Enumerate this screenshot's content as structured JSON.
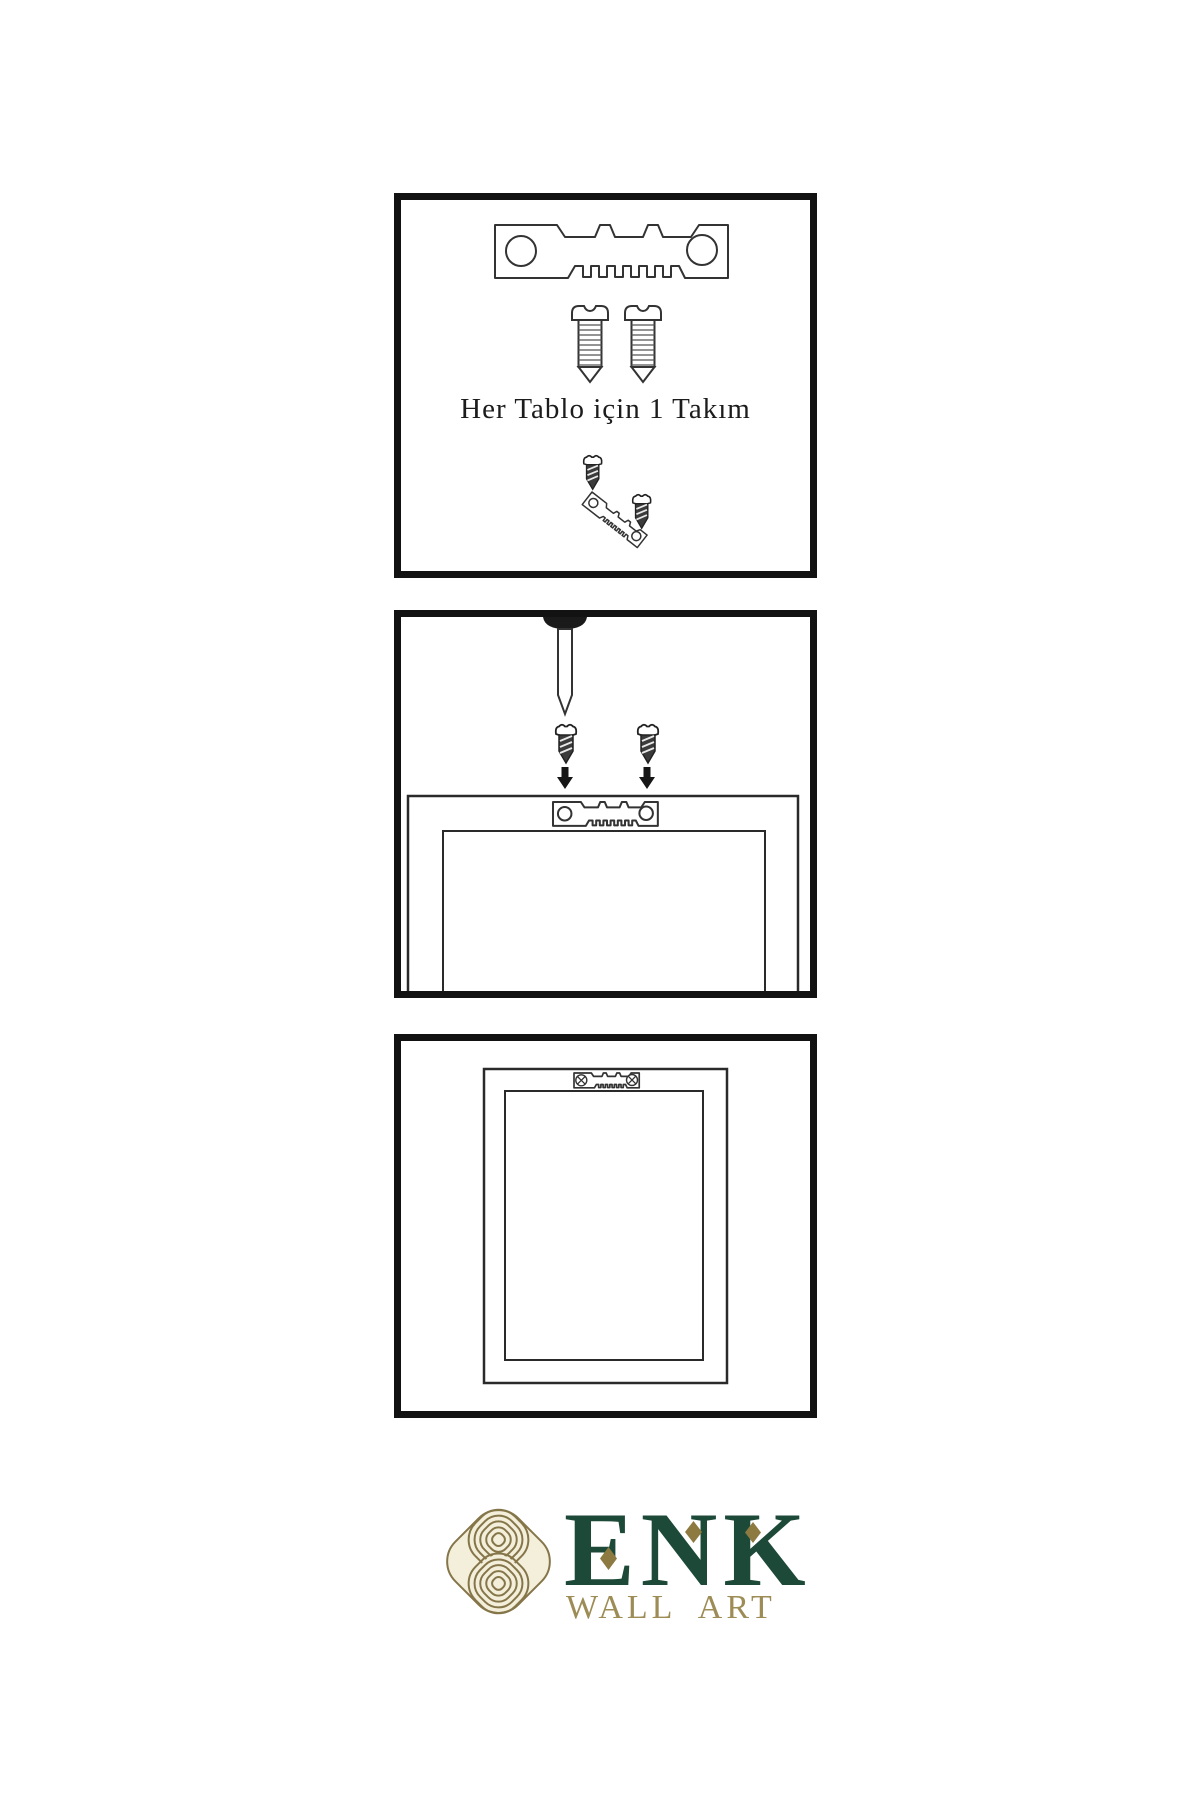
{
  "page": {
    "background": "#ffffff",
    "ink": "#333333",
    "panel_border": "#121212"
  },
  "step1": {
    "caption": "Her Tablo için 1 Takım"
  },
  "icons": {
    "panel1": [
      "sawtooth-hanger-icon",
      "screw-icon",
      "screw-icon",
      "screw-icon",
      "angled-sawtooth-hanger-icon",
      "screw-icon"
    ],
    "panel2": [
      "nail-icon",
      "screw-icon",
      "screw-icon",
      "arrow-down-icon",
      "arrow-down-icon",
      "sawtooth-hanger-icon",
      "frame-back-outline"
    ],
    "panel3": [
      "frame-back-outline",
      "sawtooth-hanger-icon",
      "phillips-screw-head-icon",
      "phillips-screw-head-icon"
    ]
  },
  "logo": {
    "brand": "ENK",
    "tagline": "WALL ART",
    "colors": {
      "brand_green": "#1d4a38",
      "tagline_gold": "#9d8c55",
      "diamond_gold": "#8c7a40",
      "knot_line": "#85764a",
      "knot_fill": "#f4efdb"
    }
  }
}
